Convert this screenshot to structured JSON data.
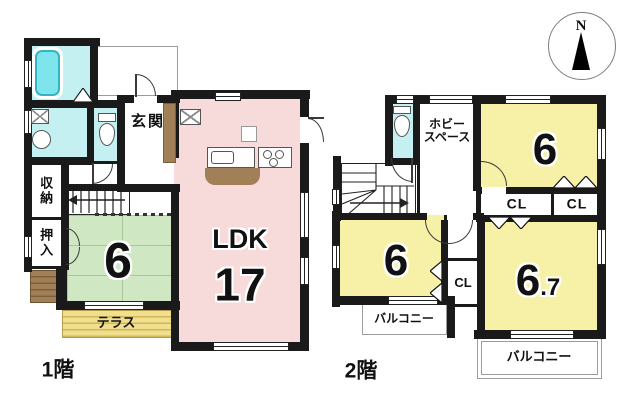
{
  "compass": {
    "north": "N"
  },
  "floor1": {
    "label": "1階",
    "entrance": "玄関",
    "storage": "収納",
    "closet": "押入",
    "ldk_label": "LDK",
    "ldk_size": "17",
    "tatami_size": "6",
    "terrace": "テラス"
  },
  "floor2": {
    "label": "2階",
    "hobby_line1": "ホビー",
    "hobby_line2": "スペース",
    "bedroom_top_size": "6",
    "bedroom_left_size": "6",
    "bedroom_right_size": "6",
    "bedroom_right_size_fraction": ".7",
    "closet1": "CL",
    "closet2": "CL",
    "closet3": "CL",
    "balcony_left": "バルコニー",
    "balcony_right": "バルコニー"
  },
  "colors": {
    "wall": "#1a1a1a",
    "ldk_pink": "#f7dada",
    "bedroom_yellow": "#f6f1a6",
    "tatami_green": "#cfe8c3",
    "wet_area_cyan": "#c4f0f2",
    "bathtub_cyan": "#7fe5ec",
    "wood_brown": "#a28057",
    "terrace_yellow": "#f0e08e"
  }
}
